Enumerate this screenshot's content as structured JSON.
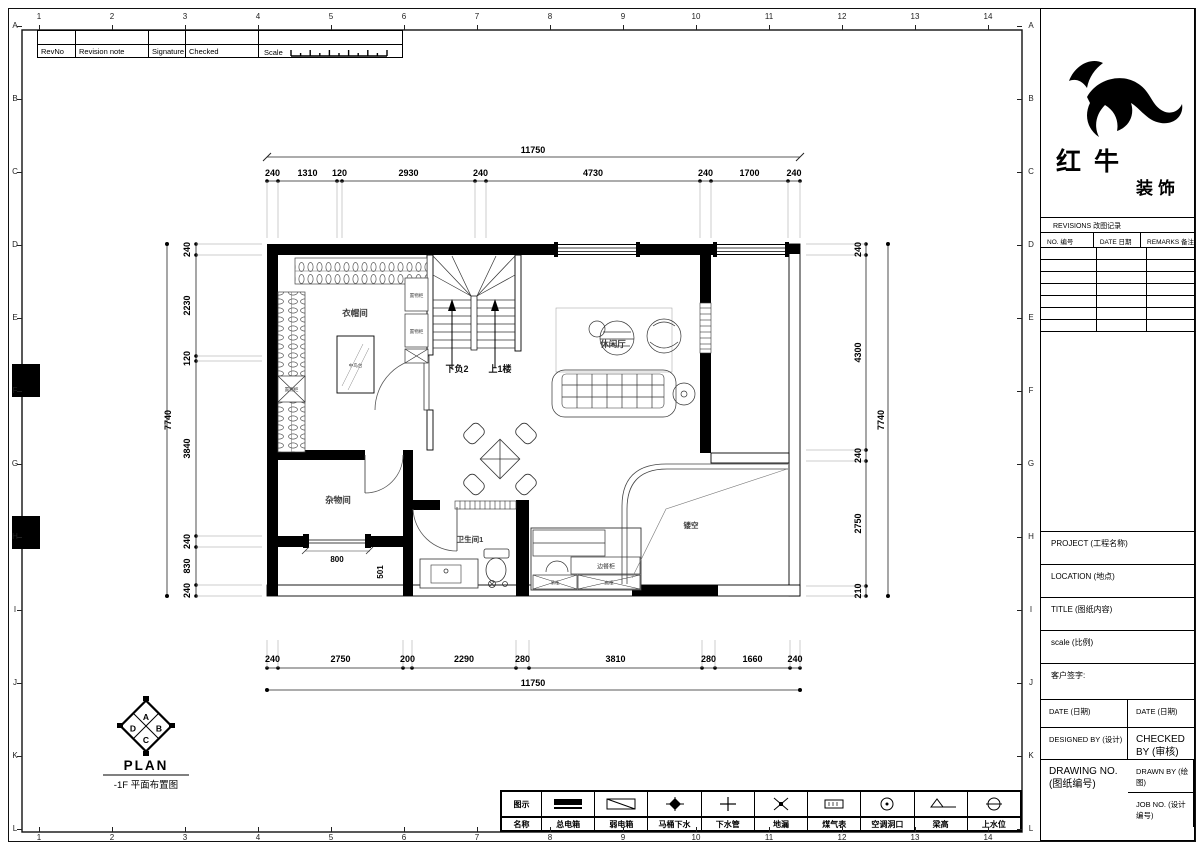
{
  "sheet": {
    "grid_columns": [
      "1",
      "2",
      "3",
      "4",
      "5",
      "6",
      "7",
      "8",
      "9",
      "10",
      "11",
      "12",
      "13",
      "14"
    ],
    "grid_rows": [
      "A",
      "B",
      "C",
      "D",
      "E",
      "F",
      "G",
      "H",
      "I",
      "J",
      "K",
      "L"
    ]
  },
  "revision_strip": {
    "col1": "RevNo",
    "col2": "Revision note",
    "col3": "Signature",
    "col4": "Checked",
    "scale_label": "Scale"
  },
  "brand": {
    "line1": "红牛",
    "line2": "装饰"
  },
  "title_block": {
    "revisions_title": "REVISIONS 改图记录",
    "rev_cols": [
      "NO. 编号",
      "DATE 日期",
      "REMARKS 备注"
    ],
    "rev_empty_rows": 7,
    "project_label": "PROJECT (工程名称)",
    "location_label": "LOCATION (地点)",
    "title_label": "TITLE (图纸内容)",
    "scale_label": "scale (比例)",
    "client_sign_label": "客户签字:",
    "date_left": "DATE (日期)",
    "date_right": "DATE (日期)",
    "designed_by": "DESIGNED BY (设计)",
    "checked_by": "CHECKED BY (审核)",
    "drawn_by": "DRAWN BY (绘图)",
    "drawing_no": "DRAWING NO. (图纸编号)",
    "job_no": "JOB NO. (设计编号)"
  },
  "plan": {
    "rooms": {
      "cloakroom": "衣帽间",
      "leisure_hall": "休闲厅",
      "storage": "杂物间",
      "bathroom": "卫生间1",
      "void": "镂空"
    },
    "stairs": {
      "down": "下负2",
      "up": "上1楼"
    },
    "furniture": {
      "island": "中岛台",
      "cabinet_upper": "置物柜",
      "cabinet_lower": "置物柜",
      "cabinet_left": "置物柜",
      "side_cabinet": "边餐柜",
      "hanging_cabinet": "吊柜",
      "tall_cabinet": "高柜"
    },
    "inline_dims": {
      "window_width": "800",
      "gap": "501"
    },
    "dimensions": {
      "top": {
        "total": "11750",
        "segments": [
          "240",
          "1310",
          "120",
          "2930",
          "240",
          "4730",
          "240",
          "1700",
          "240"
        ]
      },
      "bottom": {
        "total": "11750",
        "segments": [
          "240",
          "2750",
          "200",
          "2290",
          "280",
          "3810",
          "280",
          "1660",
          "240"
        ]
      },
      "left": {
        "total": "7740",
        "segments": [
          "240",
          "2230",
          "120",
          "3840",
          "240",
          "830",
          "240"
        ]
      },
      "right": {
        "total": "7740",
        "segments": [
          "240",
          "4300",
          "240",
          "2750",
          "210"
        ]
      }
    }
  },
  "plan_marker": {
    "letters": [
      "A",
      "B",
      "C",
      "D"
    ],
    "title": "PLAN",
    "subtitle": "-1F 平面布置图"
  },
  "legend": {
    "icon_header": "图示",
    "name_header": "名称",
    "items": [
      {
        "name": "总电箱",
        "icon": "main-electric-box"
      },
      {
        "name": "弱电箱",
        "icon": "weak-electric-box"
      },
      {
        "name": "马桶下水",
        "icon": "toilet-drain"
      },
      {
        "name": "下水管",
        "icon": "drain-pipe"
      },
      {
        "name": "地漏",
        "icon": "floor-drain"
      },
      {
        "name": "煤气表",
        "icon": "gas-meter"
      },
      {
        "name": "空调洞口",
        "icon": "ac-hole"
      },
      {
        "name": "梁高",
        "icon": "beam-height"
      },
      {
        "name": "上水位",
        "icon": "water-supply"
      }
    ]
  }
}
